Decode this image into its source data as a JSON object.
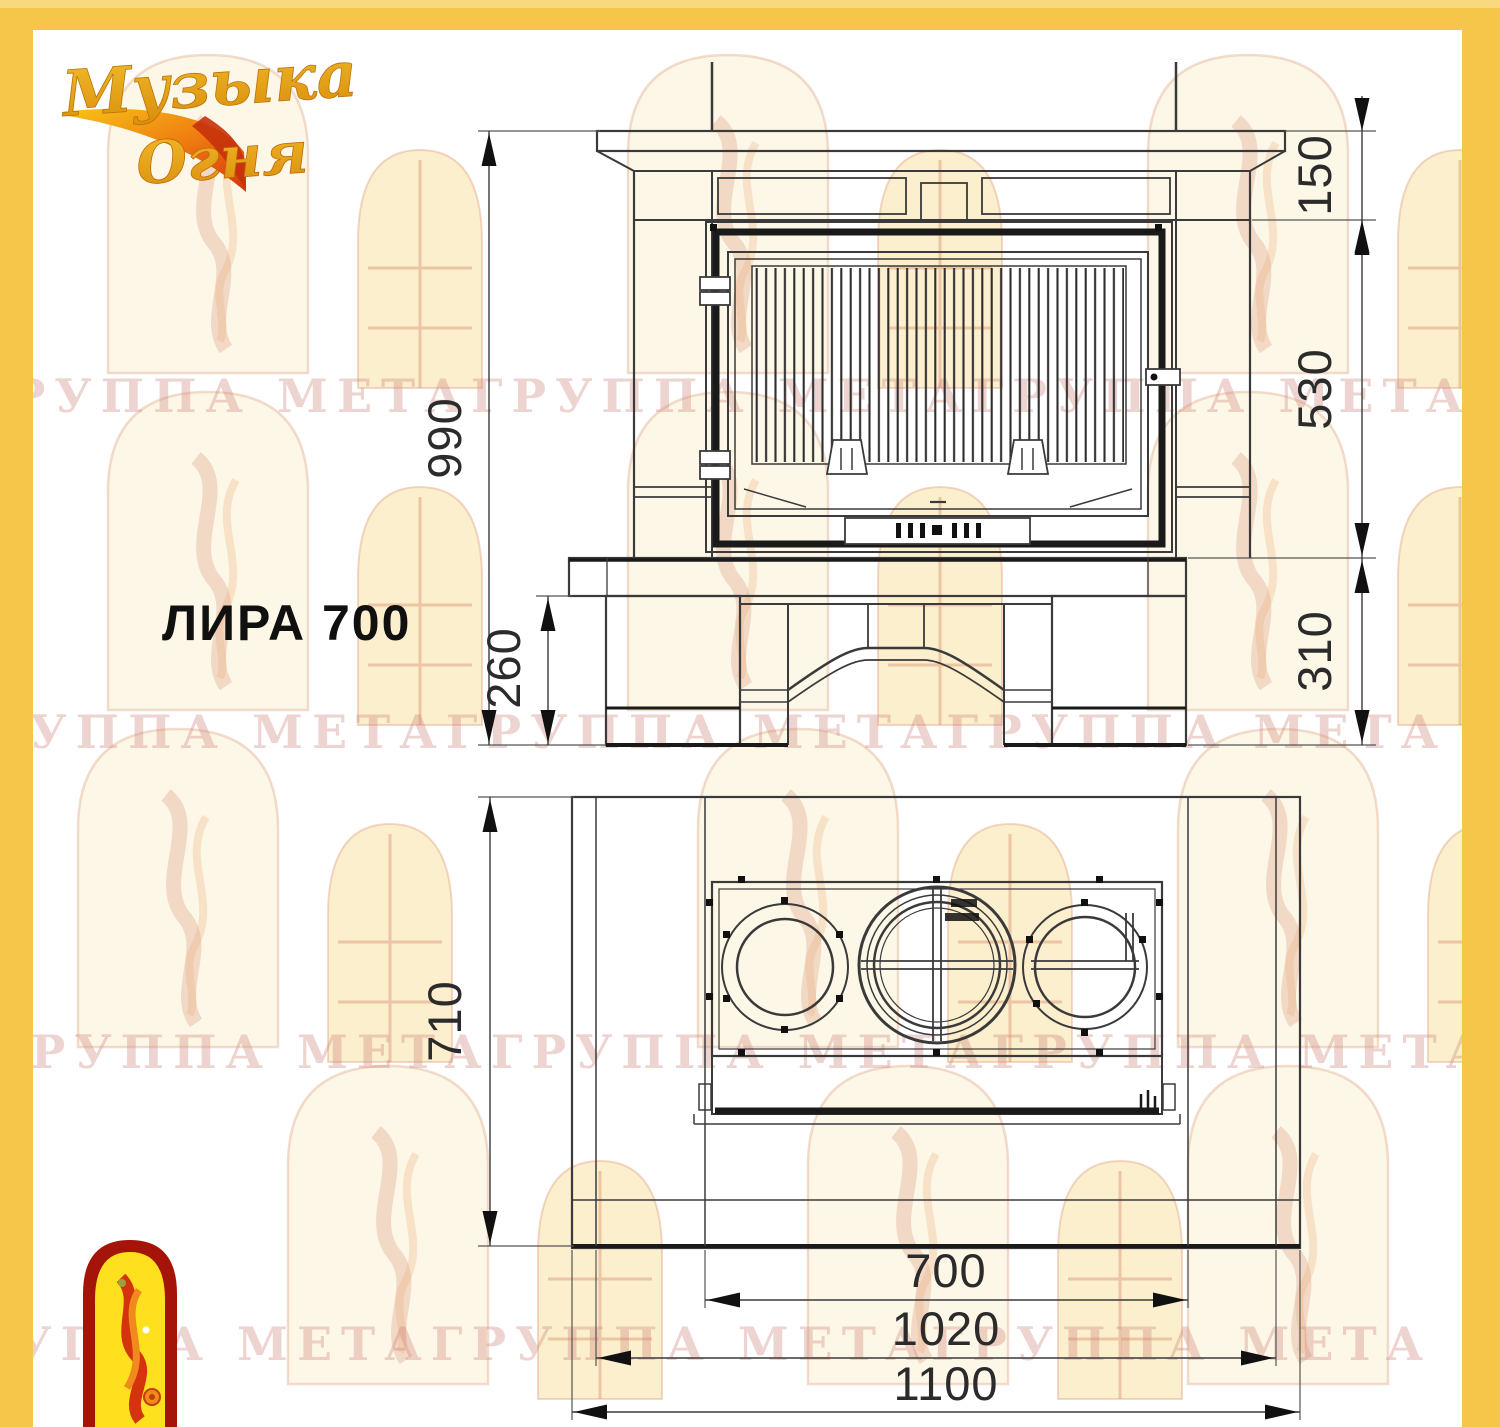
{
  "frame": {
    "color": "#F5C64A"
  },
  "paper": {
    "color": "#FFFFFF"
  },
  "logo": {
    "line1": "Музыка",
    "line2": "Огня",
    "gold_color": "#E8A01C",
    "flame_color": "#D5330E"
  },
  "emblem": {
    "border_color": "#A51408",
    "fill_color": "#FFE01F",
    "figure_colors": [
      "#D5330E",
      "#F08A1D"
    ]
  },
  "watermark": {
    "text": "ГРУППА МЕТАГРУППА МЕТАГРУППА МЕТА",
    "color": "#CE8278"
  },
  "title": {
    "model_label": "ЛИРА 700"
  },
  "drawing": {
    "line_color": "#3A3A3A",
    "front_view": {
      "description": "fireplace front elevation",
      "dims": {
        "total_height": "990",
        "cap_height": "150",
        "firebox_height": "530",
        "base_height": "310",
        "leg_height": "260"
      }
    },
    "plan_view": {
      "description": "fireplace plan view with three flue collars",
      "dims": {
        "depth": "710",
        "firebox_width": "700",
        "inner_width": "1020",
        "total_width": "1100"
      }
    }
  }
}
